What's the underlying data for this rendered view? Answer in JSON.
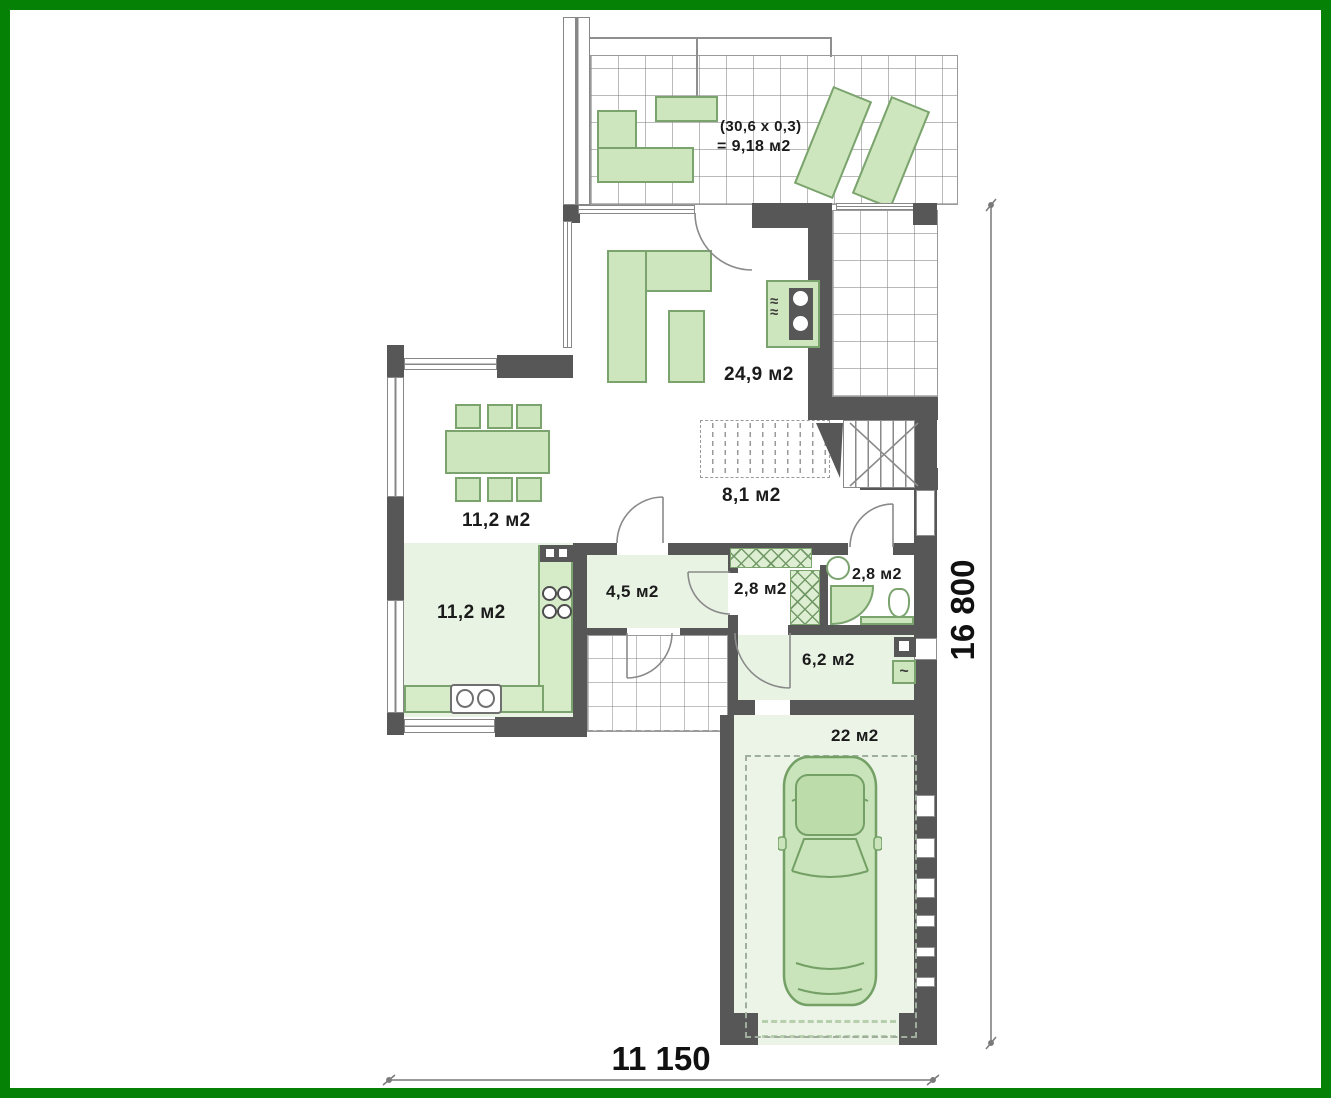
{
  "colors": {
    "frame_green": "#058205",
    "wall": "#575757",
    "floor": "#e9f3e4",
    "furniture": "#cde6bd",
    "furniture_border": "#7ba36d",
    "label_text": "#1b1b1b",
    "dim_text": "#111111"
  },
  "terrace": {
    "note_line1": "(30,6 x 0,3)",
    "note_line2": "= 9,18 м2"
  },
  "rooms": {
    "living": "24,9 м2",
    "stair_hall": "8,1  м2",
    "dining": "11,2 м2",
    "kitchen": "11,2 м2",
    "hall": "4,5 м2",
    "wc": "2,8 м2",
    "bathroom": "2,8 м2",
    "utility": "6,2 м2",
    "garage": "22 м2"
  },
  "dimensions": {
    "width_total": "11 150",
    "height_total": "16 800"
  },
  "symbols": {
    "fireplace_steam": "≈",
    "utility_sink": "~"
  }
}
